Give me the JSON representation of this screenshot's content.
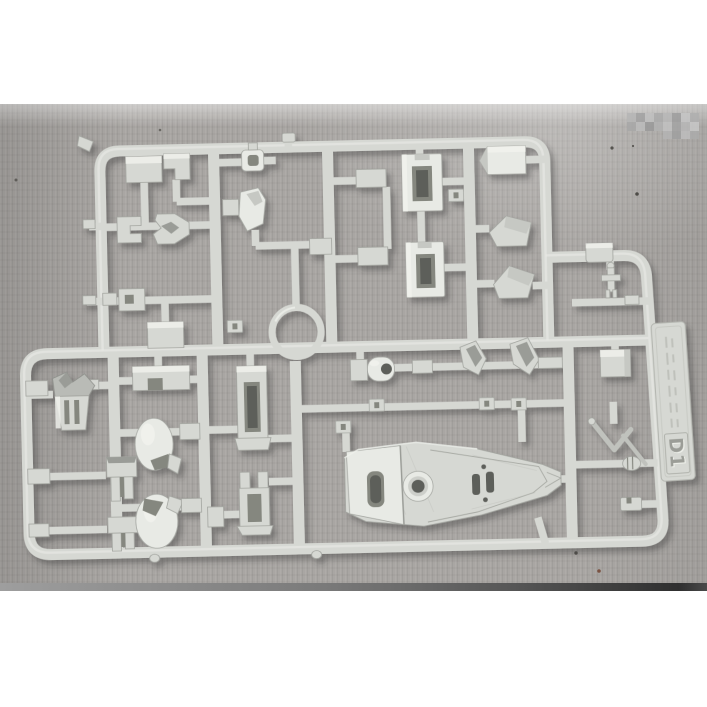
{
  "photo": {
    "runner_id_label": "D1",
    "colors": {
      "page": "#ffffff",
      "cardboard": "#a9a6a3",
      "cardboard-light": "#c2c0bd",
      "cardboard-dark": "#8f8c89",
      "plastic": "#d6d8d3",
      "plastic-light": "#e8eae5",
      "plastic-dark": "#a8aaa5",
      "crevice": "#85877f",
      "hole": "#5d5f5a",
      "strip-left": "#9e9e9e",
      "strip-right": "#2f2f2f"
    }
  }
}
